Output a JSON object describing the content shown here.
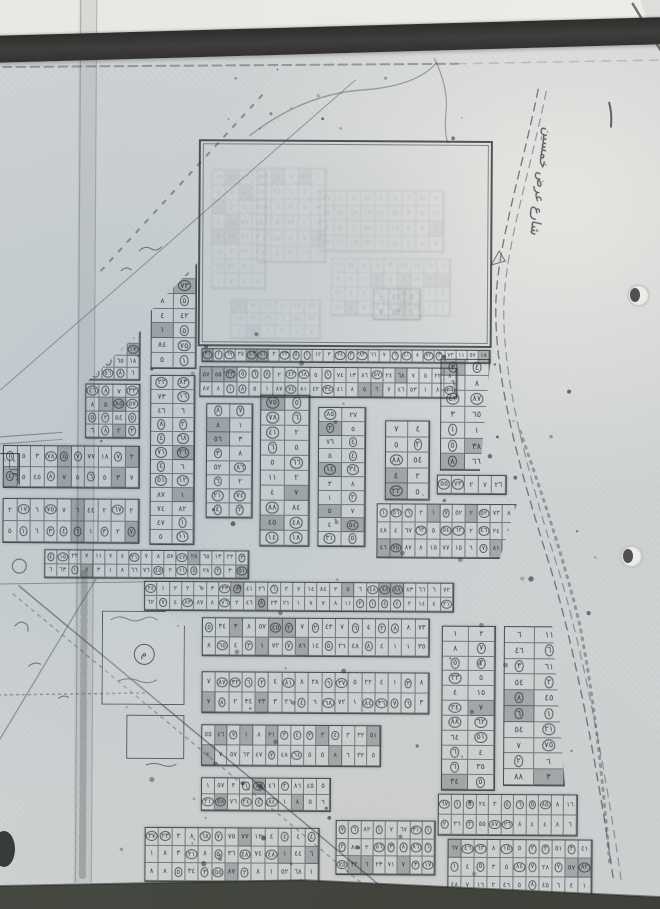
{
  "scene": {
    "description": "Photograph of a photocopied Arabic subdivision plat map lying on a desk, bound under a dark strip",
    "palette": {
      "paper": "#ced2d3",
      "paper_blue_tint": "#b2c0cb",
      "ink": "#565b5e",
      "binder_strip": "#343230",
      "desk": "#45483f",
      "backdrop": "#e9e7e2"
    }
  },
  "map": {
    "digits": "٠١٢٣٤٥٦٧٨٩",
    "reserved_area": {
      "x": 197,
      "y": 140,
      "w": 294,
      "h": 207
    },
    "ghost_blocks": [
      {
        "x": 255,
        "y": 168,
        "w": 70,
        "h": 95,
        "rows": 6,
        "cols": 5
      },
      {
        "x": 318,
        "y": 190,
        "w": 125,
        "h": 62,
        "rows": 4,
        "cols": 9
      },
      {
        "x": 330,
        "y": 258,
        "w": 120,
        "h": 58,
        "rows": 4,
        "cols": 9
      },
      {
        "x": 210,
        "y": 170,
        "w": 55,
        "h": 120,
        "rows": 8,
        "cols": 4
      },
      {
        "x": 230,
        "y": 300,
        "w": 90,
        "h": 40,
        "rows": 3,
        "cols": 6
      },
      {
        "x": 372,
        "y": 288,
        "w": 48,
        "h": 32,
        "rows": 2,
        "cols": 3,
        "opacity": 0.32
      }
    ],
    "blocks": [
      {
        "x": 201,
        "y": 349,
        "w": 289,
        "h": 14,
        "rows": 1,
        "cols": 26
      },
      {
        "x": 199,
        "y": 367,
        "w": 258,
        "h": 31,
        "rows": 2,
        "cols": 21
      },
      {
        "x": 88,
        "y": 332,
        "w": 52,
        "h": 50,
        "rows": 4,
        "cols": 4,
        "clip": "polygon(100% 0,100% 100%,0 100%)"
      },
      {
        "x": 85,
        "y": 385,
        "w": 55,
        "h": 55,
        "rows": 4,
        "cols": 4
      },
      {
        "x": 3,
        "y": 447,
        "w": 137,
        "h": 43,
        "rows": 2,
        "cols": 10
      },
      {
        "x": 3,
        "y": 500,
        "w": 137,
        "h": 45,
        "rows": 2,
        "cols": 10
      },
      {
        "x": 45,
        "y": 551,
        "w": 205,
        "h": 29,
        "rows": 2,
        "cols": 17
      },
      {
        "x": 0,
        "y": 455,
        "w": 20,
        "h": 33,
        "rows": 2,
        "cols": 2,
        "clip": "polygon(0 0,100% 0,100% 100%)"
      },
      {
        "x": 150,
        "y": 264,
        "w": 46,
        "h": 106,
        "rows": 7,
        "cols": 2,
        "clip": "polygon(100% 0,100% 100%,0 100%,0 45%)"
      },
      {
        "x": 150,
        "y": 376,
        "w": 45,
        "h": 170,
        "rows": 12,
        "cols": 2
      },
      {
        "x": 206,
        "y": 404,
        "w": 47,
        "h": 115,
        "rows": 8,
        "cols": 2
      },
      {
        "x": 260,
        "y": 395,
        "w": 50,
        "h": 152,
        "rows": 10,
        "cols": 2
      },
      {
        "x": 318,
        "y": 407,
        "w": 48,
        "h": 140,
        "rows": 10,
        "cols": 2
      },
      {
        "x": 385,
        "y": 420,
        "w": 45,
        "h": 80,
        "rows": 5,
        "cols": 2
      },
      {
        "x": 440,
        "y": 358,
        "w": 50,
        "h": 112,
        "rows": 7,
        "cols": 2,
        "clip": "polygon(0 0,100% 0,80% 100%,0 100%)"
      },
      {
        "x": 437,
        "y": 474,
        "w": 70,
        "h": 20,
        "rows": 1,
        "cols": 5
      },
      {
        "x": 377,
        "y": 503,
        "w": 140,
        "h": 55,
        "rows": 3,
        "cols": 11,
        "clip": "polygon(0 0,100% 0,88% 100%,0 100%)"
      },
      {
        "x": 145,
        "y": 582,
        "w": 310,
        "h": 30,
        "rows": 2,
        "cols": 25
      },
      {
        "x": 203,
        "y": 618,
        "w": 228,
        "h": 39,
        "rows": 2,
        "cols": 17
      },
      {
        "x": 203,
        "y": 672,
        "w": 228,
        "h": 42,
        "rows": 2,
        "cols": 17
      },
      {
        "x": 203,
        "y": 725,
        "w": 180,
        "h": 42,
        "rows": 2,
        "cols": 14
      },
      {
        "x": 203,
        "y": 778,
        "w": 130,
        "h": 34,
        "rows": 2,
        "cols": 10
      },
      {
        "x": 147,
        "y": 828,
        "w": 175,
        "h": 55,
        "rows": 3,
        "cols": 13
      },
      {
        "x": 338,
        "y": 820,
        "w": 100,
        "h": 55,
        "rows": 3,
        "cols": 8
      },
      {
        "x": 450,
        "y": 838,
        "w": 145,
        "h": 57,
        "rows": 3,
        "cols": 11
      },
      {
        "x": 443,
        "y": 625,
        "w": 54,
        "h": 165,
        "rows": 11,
        "cols": 2
      },
      {
        "x": 505,
        "y": 625,
        "w": 62,
        "h": 160,
        "rows": 10,
        "cols": 2,
        "clip": "polygon(0 0,78% 0,100% 100%,0 100%)"
      },
      {
        "x": 440,
        "y": 793,
        "w": 140,
        "h": 42,
        "rows": 2,
        "cols": 11
      }
    ],
    "mosque": {
      "x": 103,
      "y": 612,
      "w": 83,
      "h": 94,
      "symbol": "م",
      "clip": "polygon(0 0,76% 0,100% 16%,100% 100%,0 100%)"
    },
    "small_lot": {
      "x": 128,
      "y": 716,
      "w": 58,
      "h": 44
    },
    "annotations": [
      {
        "text": "شارع عرض خمسين",
        "x": 553,
        "y": 128,
        "rotate": 97,
        "size": 13
      }
    ],
    "roads": [
      {
        "d": "M536,88 C520,170 497,240 495,300 C493,375 520,470 551,566 C577,650 601,775 616,878",
        "w": 1.4,
        "dash": "8 6",
        "o": 0.75
      },
      {
        "d": "M544,90 C528,172 505,242 503,302 C501,377 528,472 559,568 C585,652 609,777 624,880",
        "w": 1.2,
        "dash": "8 6",
        "o": 0.55
      },
      {
        "d": "M520,430 C545,500 565,560 580,620 C595,690 605,780 612,860",
        "w": 3,
        "dash": "2 6",
        "o": 0.5
      },
      {
        "d": "M0,392 L353,80",
        "w": 1.1,
        "o": 0.5
      },
      {
        "d": "M100,272 L265,90",
        "w": 2,
        "dash": "4 9",
        "o": 0.6
      },
      {
        "d": "M20,588 L392,893",
        "w": 1.5,
        "o": 0.65
      },
      {
        "d": "M14,596 L385,900",
        "w": 1.5,
        "dash": "3 5",
        "o": 0.45
      },
      {
        "d": "M0,744 L97,580",
        "w": 1.2,
        "o": 0.55
      },
      {
        "d": "M0,697 L150,694",
        "w": 1.5,
        "dash": "2 4",
        "o": 0.5
      },
      {
        "d": "M0,586 L146,583",
        "w": 1,
        "o": 0.55
      },
      {
        "d": "M0,439 L62,434",
        "w": 1.1,
        "o": 0.6
      },
      {
        "d": "M0,446 L62,441",
        "w": 1.1,
        "o": 0.5
      },
      {
        "d": "M0,69 L455,63",
        "w": 2,
        "dash": "9 5",
        "o": 0.5
      },
      {
        "d": "M455,63 L660,58",
        "w": 1.5,
        "dash": "9 7",
        "o": 0.25
      },
      {
        "d": "M78,0 L78,884",
        "w": 1.2,
        "o": 0.35
      },
      {
        "d": "M94,0 L94,884",
        "w": 1.2,
        "o": 0.3
      },
      {
        "d": "M85,575 L85,880",
        "w": 7,
        "dash": "5 4",
        "o": 0.3
      },
      {
        "d": "M248,136 Q300,95 358,90 Q415,86 434,62",
        "w": 1.3,
        "o": 0.5
      },
      {
        "d": "M432,58 Q446,86 444,110 Q442,132 446,142",
        "w": 1.2,
        "o": 0.5
      },
      {
        "d": "M630,2 L664,58",
        "w": 2.5,
        "o": 0.75,
        "color": "#4b4b48"
      },
      {
        "d": "M607,101 q3,10 2,24",
        "w": 2,
        "o": 0.8,
        "color": "#3e4244"
      }
    ],
    "scribbles": [
      {
        "d": "M112,621 q8,-5 16,-1 q8,4 16,0 q8,-4 14,1"
      },
      {
        "d": "M120,682 q10,-4 20,0 q10,4 18,-1"
      },
      {
        "d": "M148,766 q8,-3 16,0 q8,3 14,-1"
      },
      {
        "d": "M138,252 q6,-6 12,-2 q5,3 10,-2"
      },
      {
        "d": "M120,272 q5,-5 10,-1"
      },
      {
        "d": "M16,628 q5,-6 10,-3 q4,2 3,8"
      },
      {
        "d": "M30,668 q6,-5 12,-2"
      },
      {
        "d": "M60,700 q5,-4 10,-1"
      },
      {
        "d": "M498,250 l-8,14 l14,-4 z",
        "fill": true
      }
    ],
    "circle_marks": [
      {
        "cx": 20,
        "cy": 568,
        "r": 7
      }
    ],
    "fold_band": {
      "x": 76,
      "w": 18
    },
    "punch_holes": [
      {
        "x": 638,
        "y": 295
      },
      {
        "x": 631,
        "y": 556
      }
    ],
    "corner_blob": {
      "x": -7,
      "y": 831,
      "w": 22,
      "h": 36
    }
  }
}
